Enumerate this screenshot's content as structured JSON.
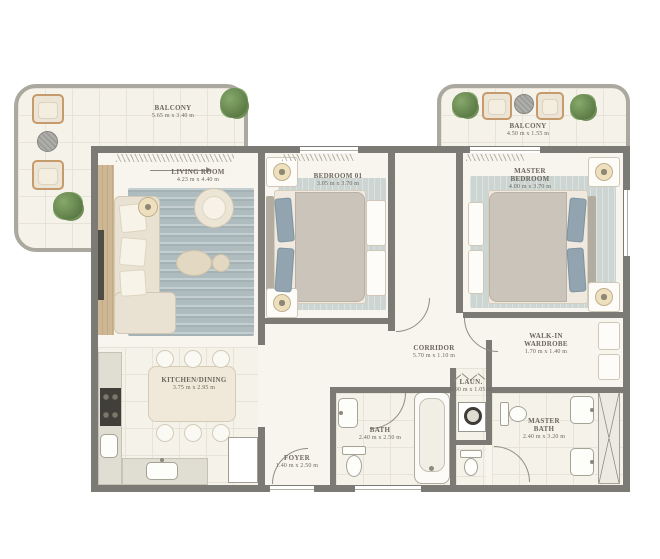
{
  "rooms": {
    "balcony_left": {
      "name": "BALCONY",
      "dims": "5.65 m x 3.40 m"
    },
    "balcony_right": {
      "name": "BALCONY",
      "dims": "4.50 m x 1.55 m"
    },
    "living": {
      "name": "LIVING ROOM",
      "dims": "4.23 m x 4.40 m"
    },
    "bedroom01": {
      "name": "BEDROOM 01",
      "dims": "3.05 m x 3.70 m"
    },
    "master_bedroom": {
      "name": "MASTER BEDROOM",
      "dims": "4.00 m x 3.70 m"
    },
    "corridor": {
      "name": "CORRIDOR",
      "dims": "5.70 m x 1.10 m"
    },
    "walkin": {
      "name": "WALK-IN WARDROBE",
      "dims": "1.70 m x 1.40 m"
    },
    "kitchen": {
      "name": "KITCHEN/DINING",
      "dims": "3.75 m x 2.95 m"
    },
    "laundry": {
      "name": "LAUN.",
      "dims": "0.90 m x 1.05 m"
    },
    "bath": {
      "name": "BATH",
      "dims": "2.40 m x 2.50 m"
    },
    "master_bath": {
      "name": "MASTER BATH",
      "dims": "2.40 m x 3.20 m"
    },
    "foyer": {
      "name": "FOYER",
      "dims": "1.40 m x 2.50 m"
    }
  },
  "colors": {
    "wall": "#7b7a75",
    "floor": "#f8f5ee",
    "floor2": "#f5f2e9",
    "tile_line": "#e7e3d8",
    "railing": "#aba99f",
    "label": "#6b675e",
    "rug": "#aebcbf",
    "rug_light": "#cdd5d3",
    "sofa": "#e9e2d2",
    "bed_duvet": "#cbc4bb",
    "pillow_blue": "#91a4af",
    "counter": "#e0ddd3",
    "dark": "#413f3a",
    "accent_wood": "#c59a6d",
    "plant_green": "#6f8f57"
  }
}
